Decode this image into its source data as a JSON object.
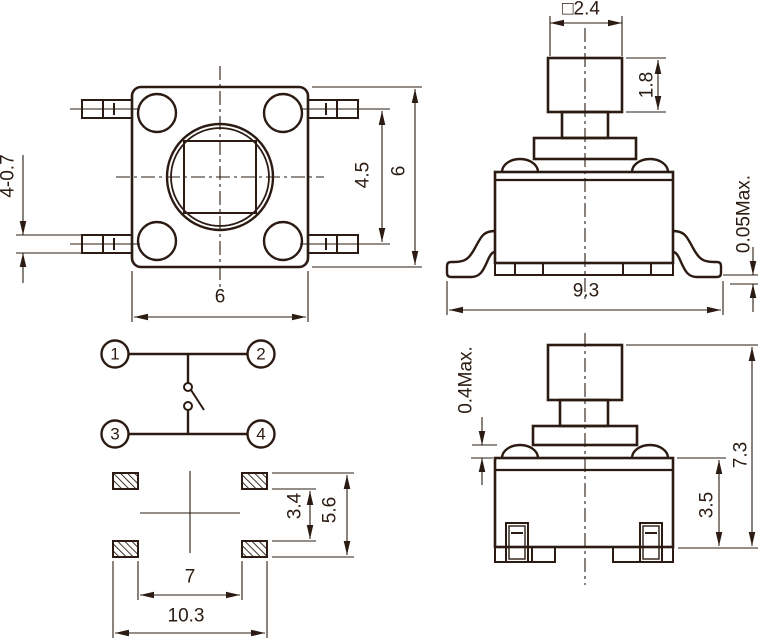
{
  "drawing": {
    "colors": {
      "line": "#2b1b12",
      "background": "#ffffff"
    },
    "top_view": {
      "lead_width": "4-0.7",
      "lead_pitch": "4.5",
      "body_height": "6",
      "body_width": "6"
    },
    "front_view": {
      "actuator_size": "□2.4",
      "actuator_height": "1.8",
      "coplanarity": "0.05Max.",
      "lead_span": "9.3"
    },
    "schematic": {
      "terminal_1": "1",
      "terminal_2": "2",
      "terminal_3": "3",
      "terminal_4": "4"
    },
    "footprint": {
      "pad_inner_vertical": "3.4",
      "pad_outer_vertical": "5.6",
      "pad_inner_horizontal": "7",
      "pad_outer_horizontal": "10.3"
    },
    "side_view": {
      "travel": "0.4Max.",
      "total_height": "7.3",
      "body_height": "3.5"
    }
  }
}
